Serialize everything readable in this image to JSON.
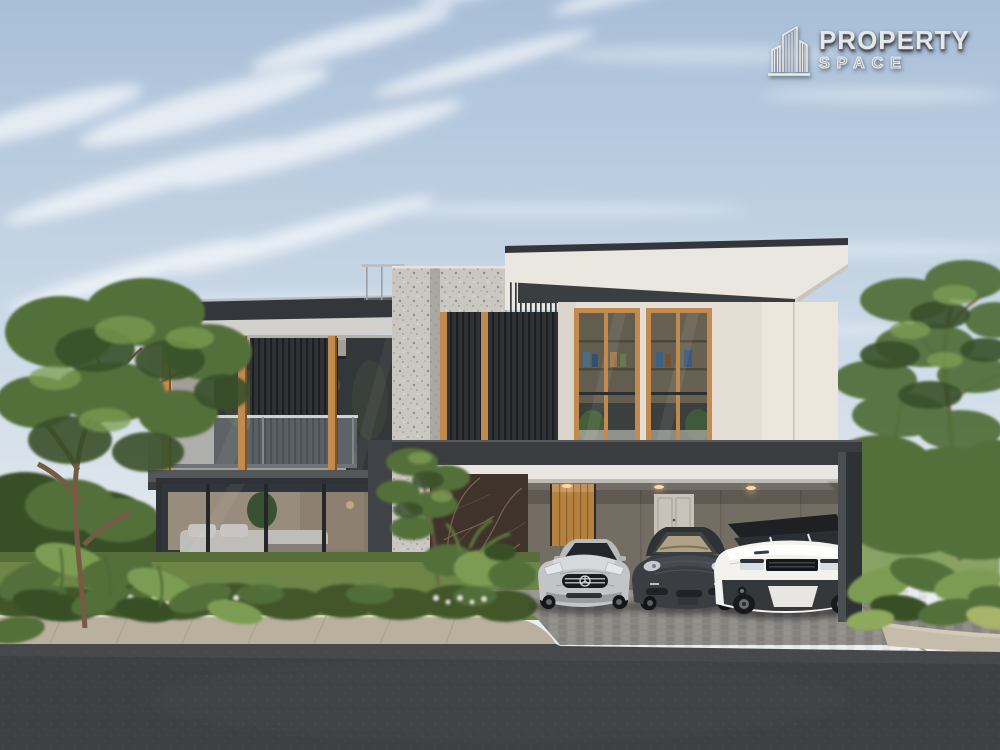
{
  "logo": {
    "line1": "PROPERTY",
    "line2": "SPACE",
    "icon": "skyline-buildings-icon"
  },
  "scene": {
    "type": "architectural-exterior-rendering",
    "subject": "Modern two-storey luxury house with timber slat screens, carport with three parked cars, landscaped garden, sidewalk and asphalt road",
    "objects": [
      "sky",
      "cirrus-clouds",
      "left-tree",
      "right-trees",
      "two-storey-house",
      "balcony-glass-railing",
      "timber-slat-screens",
      "stone-feature-column",
      "right-wing-roof",
      "carport",
      "timber-entry-door",
      "marble-feature-wall",
      "silver-sports-coupe",
      "charcoal-luxury-sedan",
      "white-compact-suv",
      "front-lawn",
      "flowering-hedge",
      "leafy-foreground-plants",
      "paved-sidewalk",
      "cobblestone-driveway",
      "asphalt-road"
    ],
    "palette": {
      "sky_top": "#a8bed8",
      "sky_mid": "#c9d8e6",
      "sky_bottom": "#e9edf0",
      "cloud": "#ffffff",
      "roof_dark": "#33363a",
      "roof_white": "#eae7e1",
      "soffit_light": "#d3d1cd",
      "wall_gray": "#b4b0ab",
      "wall_gray_dark": "#a39e98",
      "wall_cream": "#e4ded5",
      "wood": "#c18a4e",
      "slat": "#2d2f32",
      "terrazzo": "#cac7c1",
      "marble": "#40332b",
      "marble_vein": "#8d7257",
      "carport_fascia": "#3a3c3f",
      "beam_white": "#e9e6e1",
      "carport_wall": "#746d63",
      "door_wood": "#b5813f",
      "door_gray": "#c7c2ba",
      "glass_dark": "#33373a",
      "interior_warm": "#c2b098",
      "bed_white": "#e9e5dc",
      "lawn": "#6d8647",
      "hedge": "#42562c",
      "foliage": "#53703b",
      "foliage_light": "#7d9c52",
      "foliage_dark": "#394f28",
      "trunk": "#755b43",
      "sidewalk": "#c5bcab",
      "driveway": "#8d8a85",
      "road": "#3e4043",
      "car_silver": "#c2c4c7",
      "car_dark": "#3a3e43",
      "car_white": "#f3f2ef",
      "light_warm": "#ffd9a0",
      "pillar": "#2f3235"
    }
  }
}
